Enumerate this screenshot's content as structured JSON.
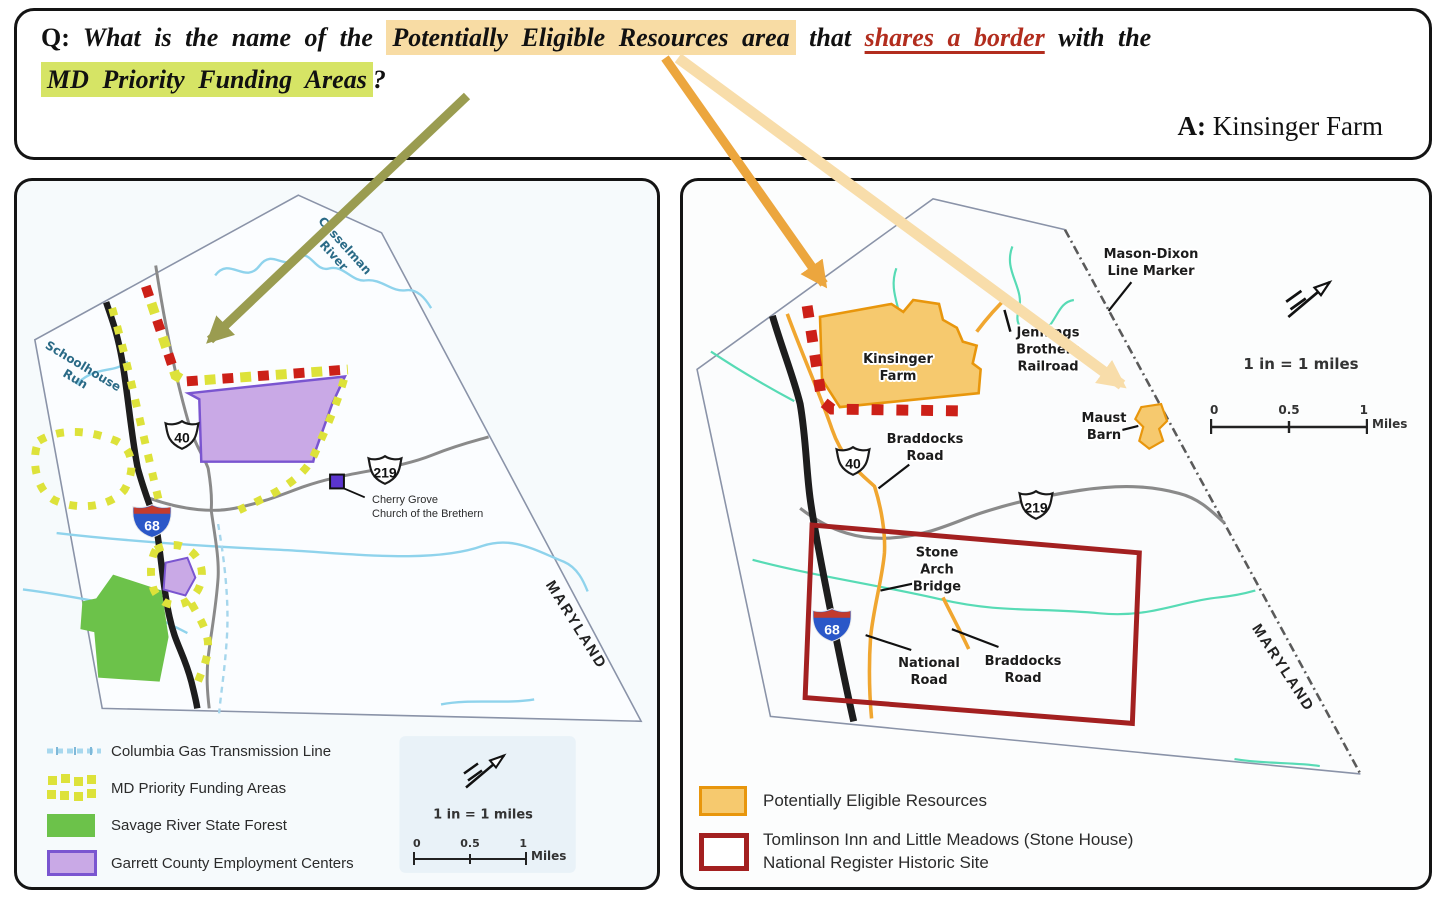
{
  "question": {
    "q_label": "Q:",
    "part1": "What is the name of the",
    "highlight_orange": "Potentially Eligible Resources area",
    "part2": "that",
    "highlight_red": "shares a border",
    "part3": "with the",
    "highlight_green": "MD Priority Funding Areas",
    "question_mark": "?",
    "a_label": "A:",
    "answer": "Kinsinger Farm"
  },
  "colors": {
    "highlight_orange": "#f8dca4",
    "highlight_green": "#d6e465",
    "red_text": "#b22d1e",
    "arrow_olive": "#9a9c50",
    "arrow_orange_dark": "#eca63e",
    "arrow_orange_light": "#f8ddaa",
    "eligible_fill": "#f6c96e",
    "eligible_border": "#e8960c",
    "historic_red": "#a32020",
    "priority_yellow": "#dde23a",
    "shared_border_red": "#cc2018",
    "forest_green": "#6cc24a",
    "employment_fill": "#c9a9e6",
    "employment_border": "#7a55d0"
  },
  "left_map": {
    "casselman_l1": "Casselman",
    "casselman_l2": "River",
    "schoolhouse_l1": "Schoolhouse",
    "schoolhouse_l2": "Run",
    "maryland": "MARYLAND",
    "church_l1": "Cherry Grove",
    "church_l2": "Church of the Brethern",
    "shield_40": "40",
    "shield_219": "219",
    "shield_68": "68",
    "scale_caption": "1 in = 1 miles",
    "scale_0": "0",
    "scale_05": "0.5",
    "scale_1": "1",
    "scale_unit": "Miles",
    "legend": {
      "gas": "Columbia Gas Transmission Line",
      "priority": "MD Priority Funding Areas",
      "forest": "Savage River State Forest",
      "employment": "Garrett County Employment Centers"
    }
  },
  "right_map": {
    "mason_l1": "Mason-Dixon",
    "mason_l2": "Line Marker",
    "kinsinger_l1": "Kinsinger",
    "kinsinger_l2": "Farm",
    "jennings_l1": "Jennings",
    "jennings_l2": "Brothers",
    "jennings_l3": "Railroad",
    "maust_l1": "Maust",
    "maust_l2": "Barn",
    "braddocks_upper_l1": "Braddocks",
    "braddocks_upper_l2": "Road",
    "stone_l1": "Stone",
    "stone_l2": "Arch",
    "stone_l3": "Bridge",
    "national_l1": "National",
    "national_l2": "Road",
    "braddocks_lower_l1": "Braddocks",
    "braddocks_lower_l2": "Road",
    "maryland": "MARYLAND",
    "shield_40": "40",
    "shield_219": "219",
    "shield_68": "68",
    "scale_caption": "1 in = 1 miles",
    "scale_0": "0",
    "scale_05": "0.5",
    "scale_1": "1",
    "scale_unit": "Miles",
    "legend": {
      "eligible": "Potentially Eligible Resources",
      "historic_l1": "Tomlinson Inn and Little Meadows (Stone House)",
      "historic_l2": "National Register Historic Site"
    }
  }
}
